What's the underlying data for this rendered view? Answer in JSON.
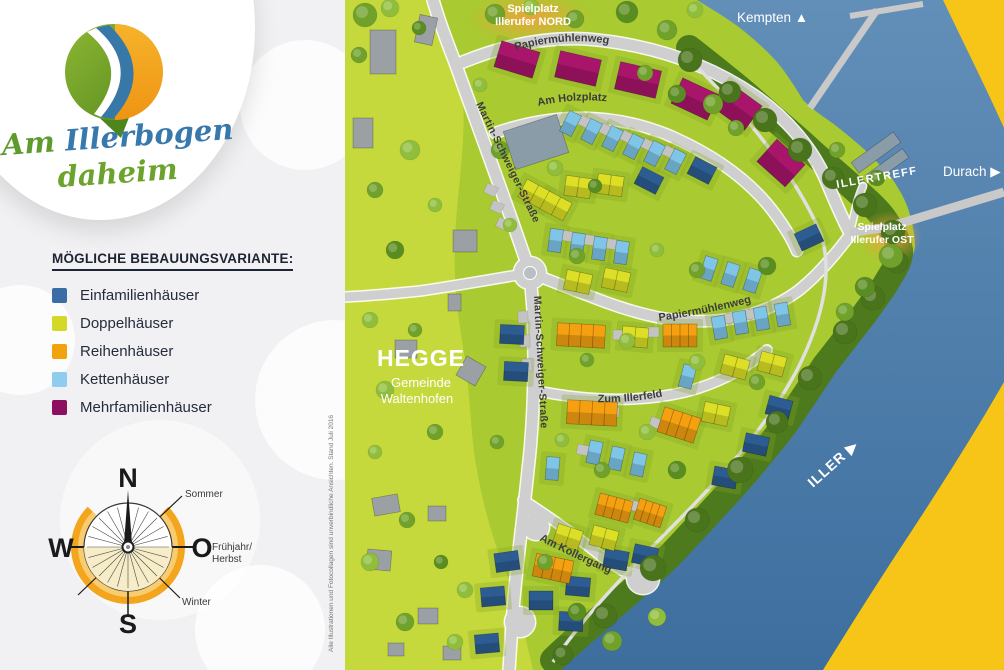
{
  "branding": {
    "title_line1_a": "Am",
    "title_line1_b": "Illerbogen",
    "title_line2": "daheim",
    "colors": {
      "green": "#76a72d",
      "blue": "#3778a9",
      "orange": "#f3a51c"
    }
  },
  "legend": {
    "title": "MÖGLICHE BEBAUUNGSVARIANTE:",
    "items": [
      {
        "key": "einfamilien",
        "label": "Einfamilienhäuser",
        "color": "#3a6da5"
      },
      {
        "key": "doppel",
        "label": "Doppelhäuser",
        "color": "#d4d826"
      },
      {
        "key": "reihen",
        "label": "Reihenhäuser",
        "color": "#f2a20d"
      },
      {
        "key": "ketten",
        "label": "Kettenhäuser",
        "color": "#8fcdee"
      },
      {
        "key": "mehrfamilien",
        "label": "Mehrfamilienhäuser",
        "color": "#8d1060"
      }
    ]
  },
  "compass": {
    "north": "N",
    "south": "S",
    "west": "W",
    "east": "O",
    "summer": "Sommer",
    "spring_fall_1": "Frühjahr/",
    "spring_fall_2": "Herbst",
    "winter": "Winter"
  },
  "footnote": "Alle Illustrationen und Fotocollagen sind unverbindliche Ansichten. Stand Juli 2016",
  "map": {
    "place_labels": {
      "playground_north_1": "Spielplatz",
      "playground_north_2": "Illerufer NORD",
      "playground_east_1": "Spielplatz",
      "playground_east_2": "Illerufer OST",
      "illertreff": "ILLERTREFF",
      "hegge": "HEGGE",
      "hegge_sub_1": "Gemeinde",
      "hegge_sub_2": "Waltenhofen",
      "kempten": "Kempten ▲",
      "durach": "Durach ▶",
      "iller": "ILLER ▶"
    },
    "street_labels": {
      "papiermuehlenweg_north": "Papiermühlenweg",
      "papiermuehlenweg_mid": "Papiermühlenweg",
      "am_holzplatz": "Am Holzplatz",
      "martin_schweiger_1": "Martin-Schweiger-Straße",
      "martin_schweiger_2": "Martin-Schweiger-Straße",
      "zum_illerfeld": "Zum Illerfeld",
      "am_kollergang": "Am Kollergang"
    },
    "palette": {
      "einfamilien": "#2c5c91",
      "doppel": "#dcdf26",
      "reihen": "#f5a011",
      "ketten": "#7ec5e8",
      "mehrfamilien": "#a9156b",
      "existing": "#9aa0a4",
      "slate": "#8b9ca9",
      "pad": "#c3c3c3",
      "land_light": "#c5d93c",
      "land_mid": "#a9ca31",
      "river_bank": "#4d7a1c",
      "water": "#4a7cab",
      "east_bank": "#f7c517",
      "road": "#cfcfcf"
    },
    "tree_shades": [
      "#90be3c",
      "#6fa12b",
      "#5a8d21",
      "#a7cd4c",
      "#4a741c"
    ],
    "buildings": [
      [
        "M",
        152,
        46,
        17,
        40,
        27
      ],
      [
        "M",
        212,
        55,
        13,
        42,
        27
      ],
      [
        "M",
        272,
        66,
        13,
        42,
        28
      ],
      [
        "M",
        330,
        85,
        25,
        40,
        28
      ],
      [
        "M",
        374,
        92,
        36,
        38,
        30
      ],
      [
        "M",
        417,
        148,
        42,
        38,
        30
      ],
      [
        "S",
        163,
        122,
        -18,
        56,
        40
      ],
      [
        "S",
        505,
        146,
        -36,
        52,
        13
      ],
      [
        "S",
        519,
        161,
        -36,
        46,
        11
      ],
      [
        "K",
        219,
        112,
        27
      ],
      [
        "K",
        240,
        120,
        27
      ],
      [
        "K",
        261,
        127,
        27
      ],
      [
        "K",
        282,
        135,
        27
      ],
      [
        "K",
        303,
        142,
        27
      ],
      [
        "K",
        324,
        150,
        27
      ],
      [
        "K",
        204,
        229,
        8
      ],
      [
        "K",
        226,
        233,
        8
      ],
      [
        "K",
        248,
        237,
        8
      ],
      [
        "K",
        270,
        241,
        8
      ],
      [
        "K",
        357,
        257,
        18
      ],
      [
        "K",
        379,
        263,
        18
      ],
      [
        "K",
        401,
        269,
        18
      ],
      [
        "K",
        368,
        316,
        -10
      ],
      [
        "K",
        389,
        311,
        -10
      ],
      [
        "K",
        410,
        307,
        -10
      ],
      [
        "K",
        431,
        303,
        -10
      ],
      [
        "K",
        243,
        441,
        12
      ],
      [
        "K",
        265,
        447,
        12
      ],
      [
        "K",
        287,
        453,
        12
      ],
      [
        "K",
        201,
        457,
        5
      ],
      [
        "K",
        336,
        365,
        15
      ],
      [
        "E",
        292,
        171,
        27
      ],
      [
        "E",
        345,
        161,
        27
      ],
      [
        "E",
        452,
        228,
        -25
      ],
      [
        "E",
        155,
        325,
        3
      ],
      [
        "E",
        159,
        362,
        3
      ],
      [
        "E",
        422,
        398,
        15
      ],
      [
        "E",
        399,
        435,
        12
      ],
      [
        "E",
        368,
        468,
        10
      ],
      [
        "E",
        150,
        552,
        -8
      ],
      [
        "E",
        136,
        587,
        -5
      ],
      [
        "E",
        184,
        591,
        0
      ],
      [
        "E",
        221,
        577,
        5
      ],
      [
        "E",
        288,
        546,
        12
      ],
      [
        "E",
        130,
        634,
        -5
      ],
      [
        "E",
        214,
        612,
        3
      ],
      [
        "E",
        259,
        550,
        10
      ],
      [
        "D",
        176,
        184,
        28
      ],
      [
        "D",
        198,
        196,
        28
      ],
      [
        "D",
        220,
        177,
        8
      ],
      [
        "D",
        252,
        175,
        8
      ],
      [
        "D",
        220,
        272,
        12
      ],
      [
        "D",
        258,
        270,
        12
      ],
      [
        "D",
        277,
        327,
        5
      ],
      [
        "D",
        377,
        357,
        15
      ],
      [
        "D",
        414,
        354,
        15
      ],
      [
        "D",
        358,
        404,
        12
      ],
      [
        "D",
        210,
        527,
        18
      ],
      [
        "D",
        246,
        528,
        15
      ],
      [
        "R",
        212,
        324,
        3,
        48,
        23
      ],
      [
        "R",
        318,
        324,
        0,
        34,
        23
      ],
      [
        "R",
        222,
        401,
        3,
        50,
        24
      ],
      [
        "R",
        315,
        412,
        18,
        38,
        26
      ],
      [
        "R",
        252,
        497,
        15,
        34,
        22
      ],
      [
        "R",
        291,
        502,
        18,
        28,
        22
      ],
      [
        "R",
        189,
        557,
        12,
        38,
        23
      ],
      [
        "G",
        25,
        30,
        0,
        26,
        44
      ],
      [
        "G",
        72,
        16,
        12,
        18,
        28
      ],
      [
        "G",
        8,
        118,
        0,
        20,
        30
      ],
      [
        "G",
        108,
        230,
        0,
        24,
        22
      ],
      [
        "G",
        103,
        294,
        0,
        13,
        17
      ],
      [
        "G",
        115,
        360,
        30,
        22,
        22
      ],
      [
        "G",
        50,
        340,
        0,
        22,
        18
      ],
      [
        "G",
        28,
        496,
        -10,
        26,
        18
      ],
      [
        "G",
        83,
        506,
        0,
        18,
        15
      ],
      [
        "G",
        22,
        550,
        5,
        24,
        20
      ],
      [
        "G",
        73,
        608,
        0,
        20,
        16
      ],
      [
        "G",
        98,
        646,
        0,
        18,
        14
      ],
      [
        "G",
        43,
        643,
        0,
        16,
        13
      ],
      [
        "P",
        234,
        117,
        27
      ],
      [
        "P",
        255,
        125,
        27
      ],
      [
        "P",
        276,
        132,
        27
      ],
      [
        "P",
        297,
        140,
        27
      ],
      [
        "P",
        318,
        147,
        27
      ],
      [
        "P",
        216,
        231,
        8
      ],
      [
        "P",
        238,
        235,
        8
      ],
      [
        "P",
        260,
        239,
        8
      ],
      [
        "P",
        380,
        313,
        -10
      ],
      [
        "P",
        401,
        309,
        -10
      ],
      [
        "P",
        268,
        330,
        3
      ],
      [
        "P",
        302,
        327,
        0
      ],
      [
        "P",
        262,
        407,
        3
      ],
      [
        "P",
        305,
        418,
        18
      ],
      [
        "P",
        284,
        501,
        16
      ],
      [
        "P",
        205,
        561,
        12
      ],
      [
        "P",
        232,
        445,
        12
      ],
      [
        "P",
        140,
        185,
        25
      ],
      [
        "P",
        146,
        202,
        25
      ],
      [
        "P",
        152,
        219,
        25
      ],
      [
        "P",
        172,
        312,
        88
      ],
      [
        "P",
        174,
        336,
        88
      ],
      [
        "P",
        176,
        360,
        88
      ]
    ],
    "trees": [
      [
        20,
        15,
        12,
        1
      ],
      [
        45,
        8,
        9,
        0
      ],
      [
        74,
        28,
        7,
        2
      ],
      [
        14,
        55,
        8,
        1
      ],
      [
        150,
        14,
        10,
        1
      ],
      [
        186,
        7,
        8,
        0
      ],
      [
        230,
        19,
        9,
        1
      ],
      [
        282,
        12,
        11,
        2
      ],
      [
        322,
        30,
        10,
        1
      ],
      [
        350,
        10,
        8,
        0
      ],
      [
        135,
        85,
        7,
        0
      ],
      [
        300,
        73,
        8,
        1
      ],
      [
        332,
        94,
        9,
        2
      ],
      [
        368,
        104,
        10,
        1
      ],
      [
        391,
        128,
        8,
        1
      ],
      [
        345,
        60,
        12,
        4
      ],
      [
        385,
        92,
        11,
        4
      ],
      [
        420,
        120,
        12,
        4
      ],
      [
        455,
        150,
        12,
        4
      ],
      [
        488,
        178,
        11,
        4
      ],
      [
        520,
        205,
        12,
        4
      ],
      [
        548,
        232,
        12,
        4
      ],
      [
        552,
        262,
        11,
        4
      ],
      [
        528,
        298,
        12,
        4
      ],
      [
        500,
        332,
        12,
        4
      ],
      [
        465,
        378,
        12,
        4
      ],
      [
        432,
        422,
        11,
        4
      ],
      [
        395,
        470,
        13,
        4
      ],
      [
        352,
        520,
        12,
        4
      ],
      [
        308,
        568,
        13,
        4
      ],
      [
        260,
        616,
        12,
        4
      ],
      [
        218,
        655,
        10,
        4
      ],
      [
        492,
        150,
        8,
        1
      ],
      [
        532,
        178,
        8,
        2
      ],
      [
        546,
        256,
        12,
        1
      ],
      [
        520,
        287,
        10,
        2
      ],
      [
        500,
        312,
        9,
        1
      ],
      [
        155,
        150,
        9,
        1
      ],
      [
        210,
        168,
        8,
        0
      ],
      [
        250,
        186,
        7,
        2
      ],
      [
        165,
        225,
        7,
        0
      ],
      [
        232,
        256,
        8,
        1
      ],
      [
        312,
        250,
        7,
        0
      ],
      [
        352,
        270,
        8,
        1
      ],
      [
        422,
        266,
        9,
        2
      ],
      [
        282,
        341,
        8,
        0
      ],
      [
        242,
        360,
        7,
        1
      ],
      [
        352,
        362,
        8,
        0
      ],
      [
        412,
        382,
        8,
        1
      ],
      [
        302,
        432,
        8,
        0
      ],
      [
        257,
        470,
        8,
        1
      ],
      [
        332,
        470,
        9,
        2
      ],
      [
        217,
        440,
        7,
        0
      ],
      [
        152,
        442,
        7,
        1
      ],
      [
        65,
        150,
        10,
        0
      ],
      [
        30,
        190,
        8,
        1
      ],
      [
        90,
        205,
        7,
        0
      ],
      [
        50,
        250,
        9,
        2
      ],
      [
        25,
        320,
        8,
        0
      ],
      [
        70,
        330,
        7,
        1
      ],
      [
        40,
        390,
        9,
        0
      ],
      [
        90,
        432,
        8,
        1
      ],
      [
        30,
        452,
        7,
        0
      ],
      [
        62,
        520,
        8,
        1
      ],
      [
        25,
        562,
        9,
        0
      ],
      [
        96,
        562,
        7,
        2
      ],
      [
        120,
        590,
        8,
        0
      ],
      [
        60,
        622,
        9,
        1
      ],
      [
        110,
        642,
        8,
        0
      ],
      [
        200,
        562,
        8,
        1
      ],
      [
        232,
        612,
        9,
        2
      ],
      [
        267,
        641,
        10,
        1
      ],
      [
        312,
        617,
        9,
        0
      ]
    ]
  }
}
